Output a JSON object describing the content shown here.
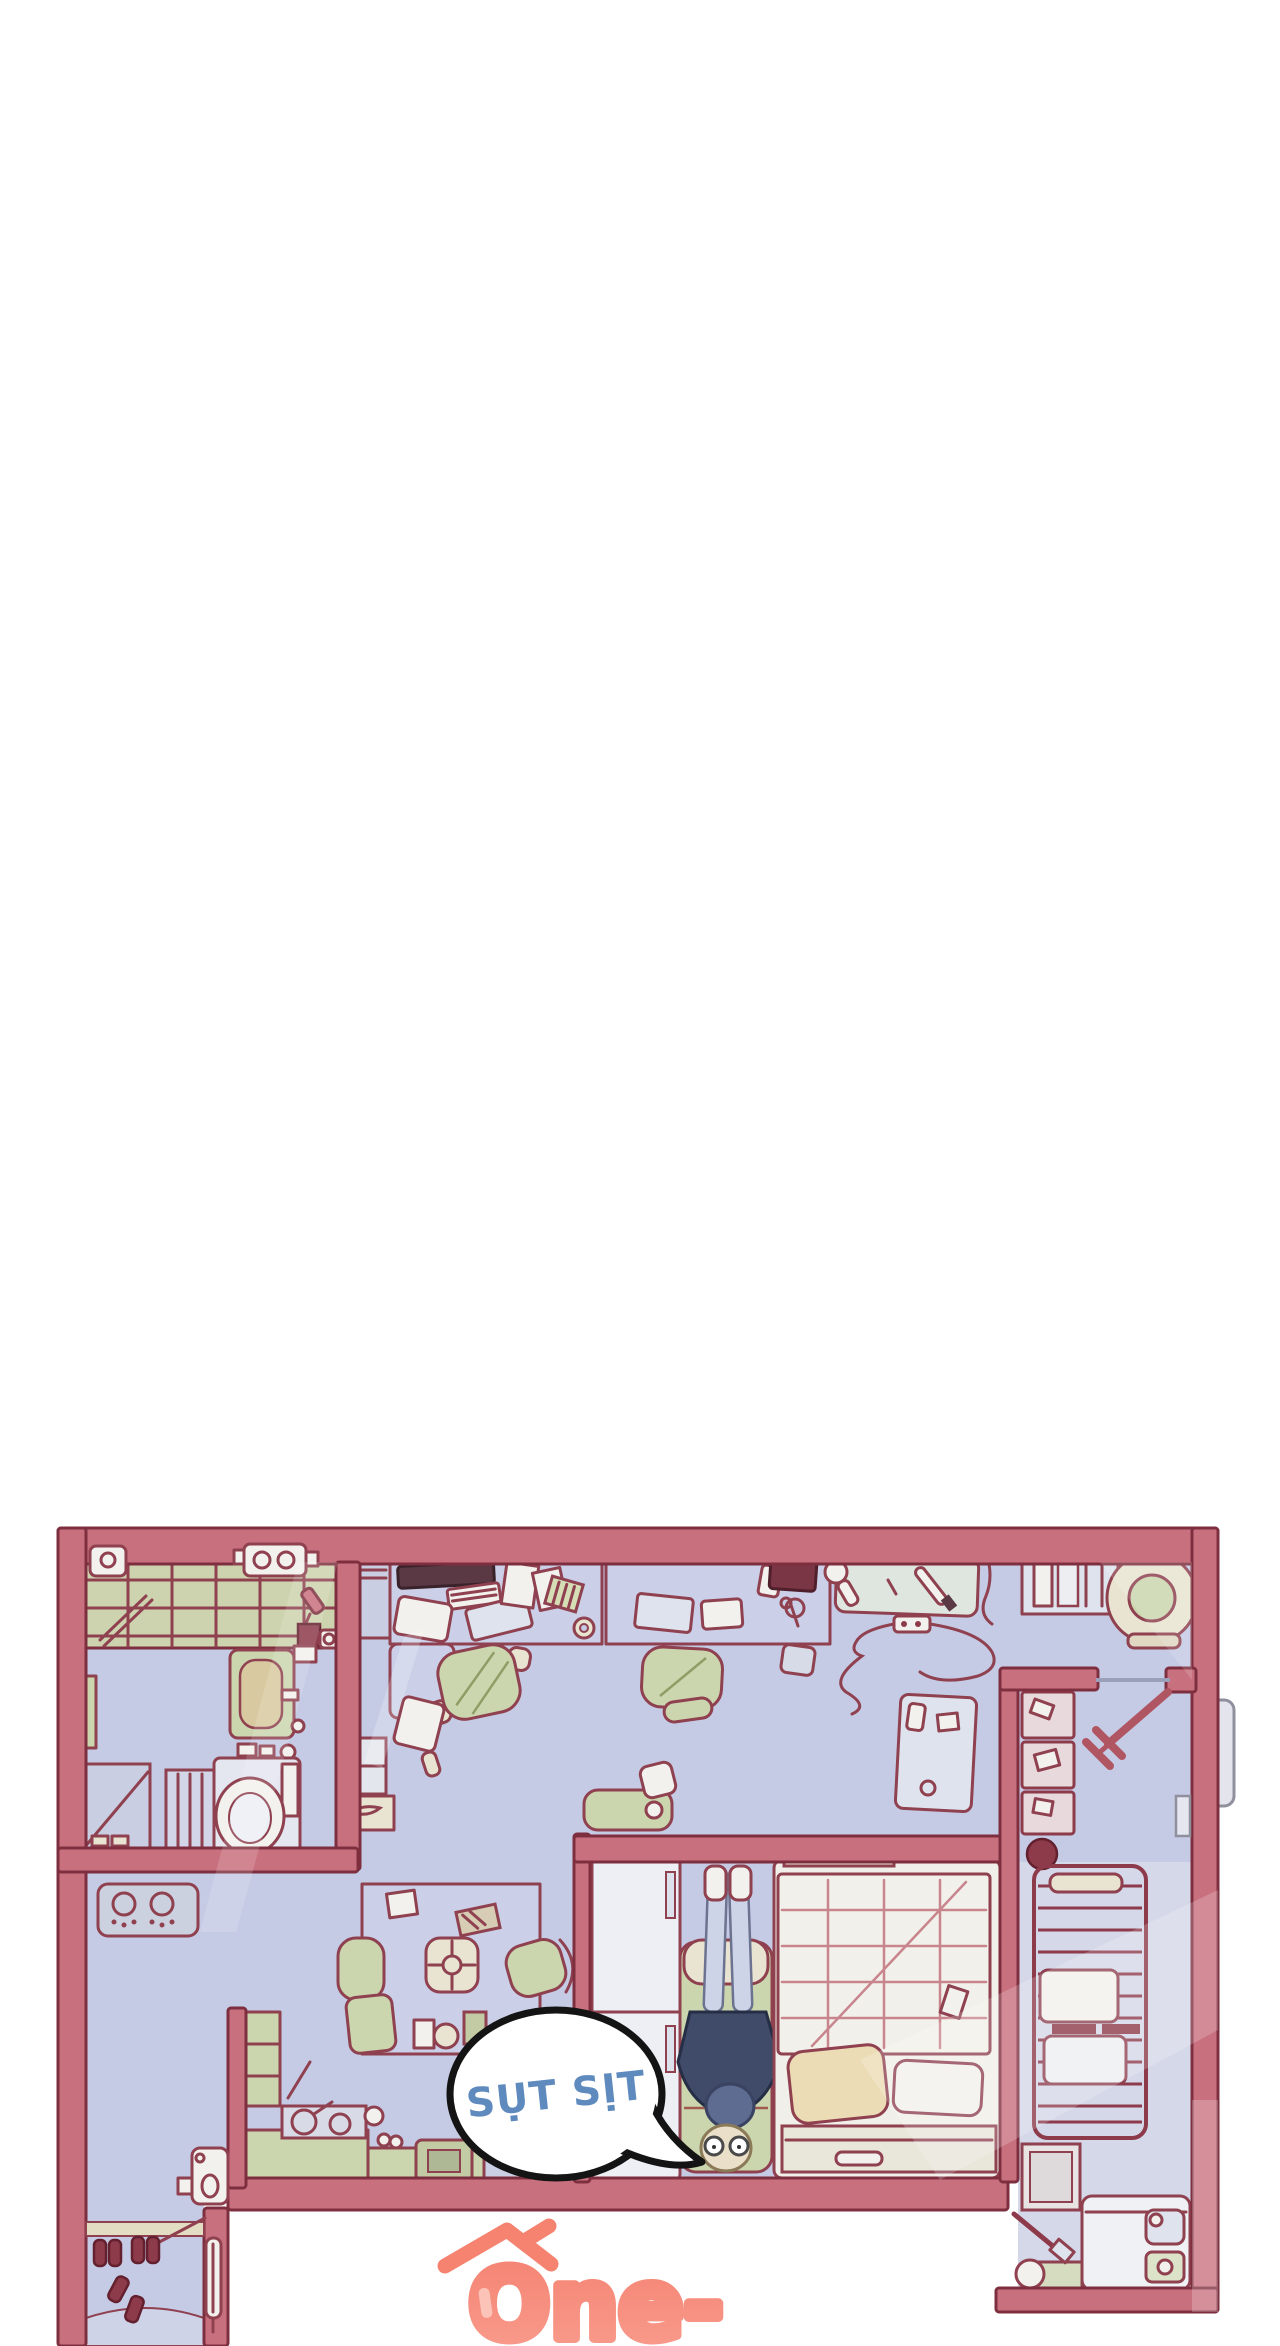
{
  "panel": {
    "type": "webtoon comic panel, top-down apartment floor plan",
    "background": "#FFFFFF"
  },
  "speech_bubble": {
    "text": "SỤT SỊT",
    "text_color": "#5F8ABD",
    "fill": "#FFFFFF",
    "outline": "#141414"
  },
  "logo": {
    "text": "One-",
    "color": "#F5897B",
    "icon": "house-roof-icon"
  },
  "palette": {
    "wall": "#C9707E",
    "wall_outline": "#7E2F3F",
    "floor": "#C6CBE5",
    "corridor_floor": "#D5D8E9",
    "tile_green": "#CDD3AE",
    "furniture_green": "#CBD6AE",
    "cream": "#E9E4D2",
    "navy_clothes": "#3F4B68",
    "dark_red_items": "#8D3A4A"
  }
}
